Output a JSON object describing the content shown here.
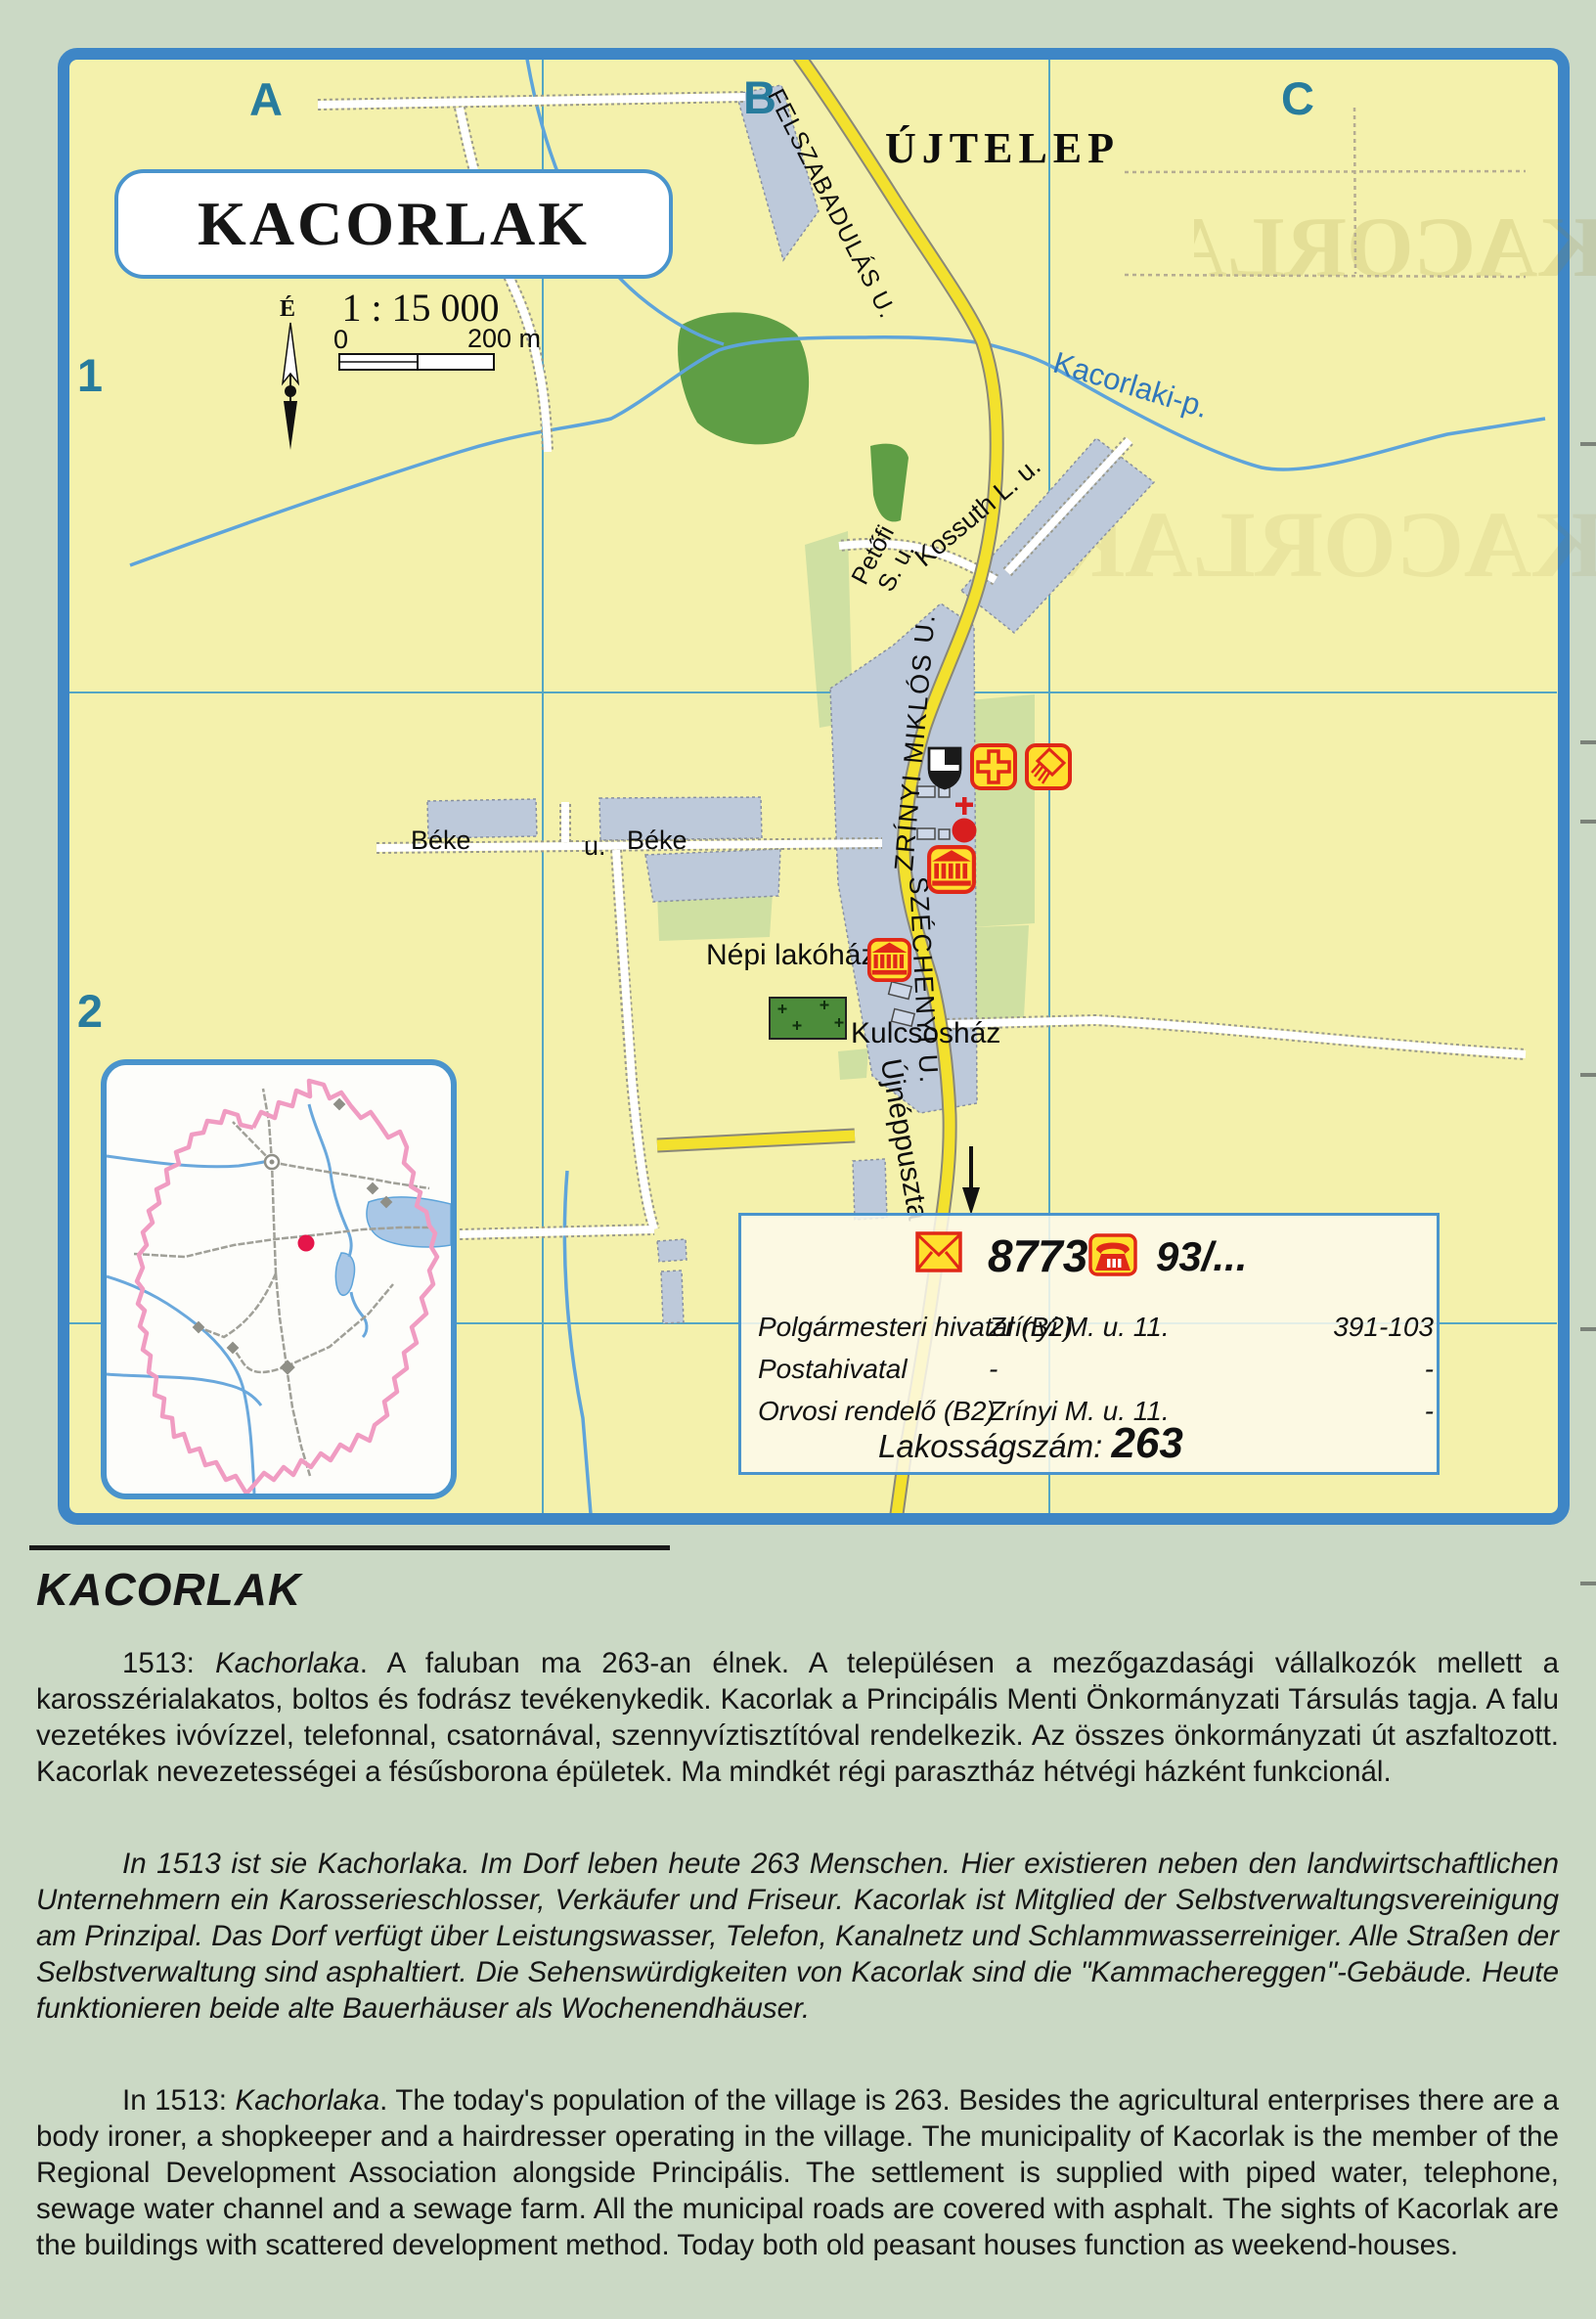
{
  "colors": {
    "frame_blue": "#3e86c6",
    "grid_teal": "#287c9d",
    "map_yellow": "#f4f1ac",
    "road_yellow": "#f3e12d",
    "water_blue": "#5ea4da",
    "icon_red": "#e02818",
    "icon_yellow": "#ffdf2e",
    "marker_red": "#e5154a"
  },
  "map": {
    "title": "KACORLAK",
    "place_label": "ÚJTELEP",
    "scale_text": "1 : 15 000",
    "scale_zero": "0",
    "scale_distance": "200 m",
    "north_label": "É",
    "grid": {
      "col_a": "A",
      "col_b": "B",
      "col_c": "C",
      "row_1": "1",
      "row_2": "2"
    },
    "streets": {
      "felszabadulas": "FELSZABADULÁS U.",
      "kossuth": "Kossuth L. u.",
      "petofi_line1": "Petőfi",
      "petofi_line2": "S. u.",
      "zrinyi": "ZRÍNYI MIKLÓS U.",
      "szechenyi": "SZÉCHENYI U.",
      "beke1": "Béke",
      "beke_u": "u.",
      "beke2": "Béke",
      "ujneppuszta": "Újnéppuszta"
    },
    "stream_label": "Kacorlaki-p.",
    "poi": {
      "nepi_lakohaz": "Népi lakóház",
      "kulcsoshaz": "Kulcsosház"
    },
    "ghost_text": "KACORLAK"
  },
  "infobox": {
    "postal_code": "8773",
    "phone_prefix": "93/...",
    "rows": [
      {
        "name": "Polgármesteri hivatal (B2)",
        "address": "Zrínyi M. u. 11.",
        "phone": "391-103"
      },
      {
        "name": "Postahivatal",
        "address": "-",
        "phone": "-"
      },
      {
        "name": "Orvosi rendelő (B2)",
        "address": "Zrínyi M. u. 11.",
        "phone": "-"
      }
    ],
    "population_label": "Lakosságszám:",
    "population_value": "263"
  },
  "article": {
    "heading": "KACORLAK",
    "hu": {
      "lead": "1513: ",
      "name": "Kachorlaka",
      "body": ". A faluban ma 263-an élnek. A településen a mezőgazdasági vállalkozók mellett a karosszérialakatos, boltos és fodrász tevékenykedik. Kacorlak a Principális Menti Önkormányzati Társulás tagja. A falu vezetékes ivóvízzel, telefonnal, csatornával, szennyvíztisztítóval rendelkezik. Az összes önkormányzati út aszfaltozott. Kacorlak nevezetességei a fésűsborona épületek. Ma mindkét régi parasztház hétvégi házként funkcionál."
    },
    "de": "In 1513 ist sie Kachorlaka. Im Dorf leben heute 263 Menschen. Hier existieren neben den landwirtschaftlichen Unternehmern ein Karosserieschlosser, Verkäufer und Friseur. Kacorlak ist Mitglied der Selbstverwaltungsvereinigung am Prinzipal. Das Dorf verfügt über Leistungswasser, Telefon, Kanalnetz und Schlammwasserreiniger. Alle Straßen der Selbstverwaltung sind asphaltiert. Die Sehenswürdigkeiten von Kacorlak sind die \"Kammachereggen\"-Gebäude. Heute funktionieren beide alte Bauerhäuser als Wochenendhäuser.",
    "en": {
      "lead": "In 1513: ",
      "name": "Kachorlaka",
      "body": ". The today's population of the village is 263. Besides the agricultural enterprises there are a body ironer, a shopkeeper and a hairdresser operating in the village. The municipality of Kacorlak is the member of the Regional Development Association alongside Principális. The settlement is supplied with piped water, telephone, sewage water channel and a sewage farm. All the municipal roads are covered with asphalt. The sights of Kacorlak are the buildings with scattered development method. Today both old peasant houses function as weekend-houses."
    }
  }
}
